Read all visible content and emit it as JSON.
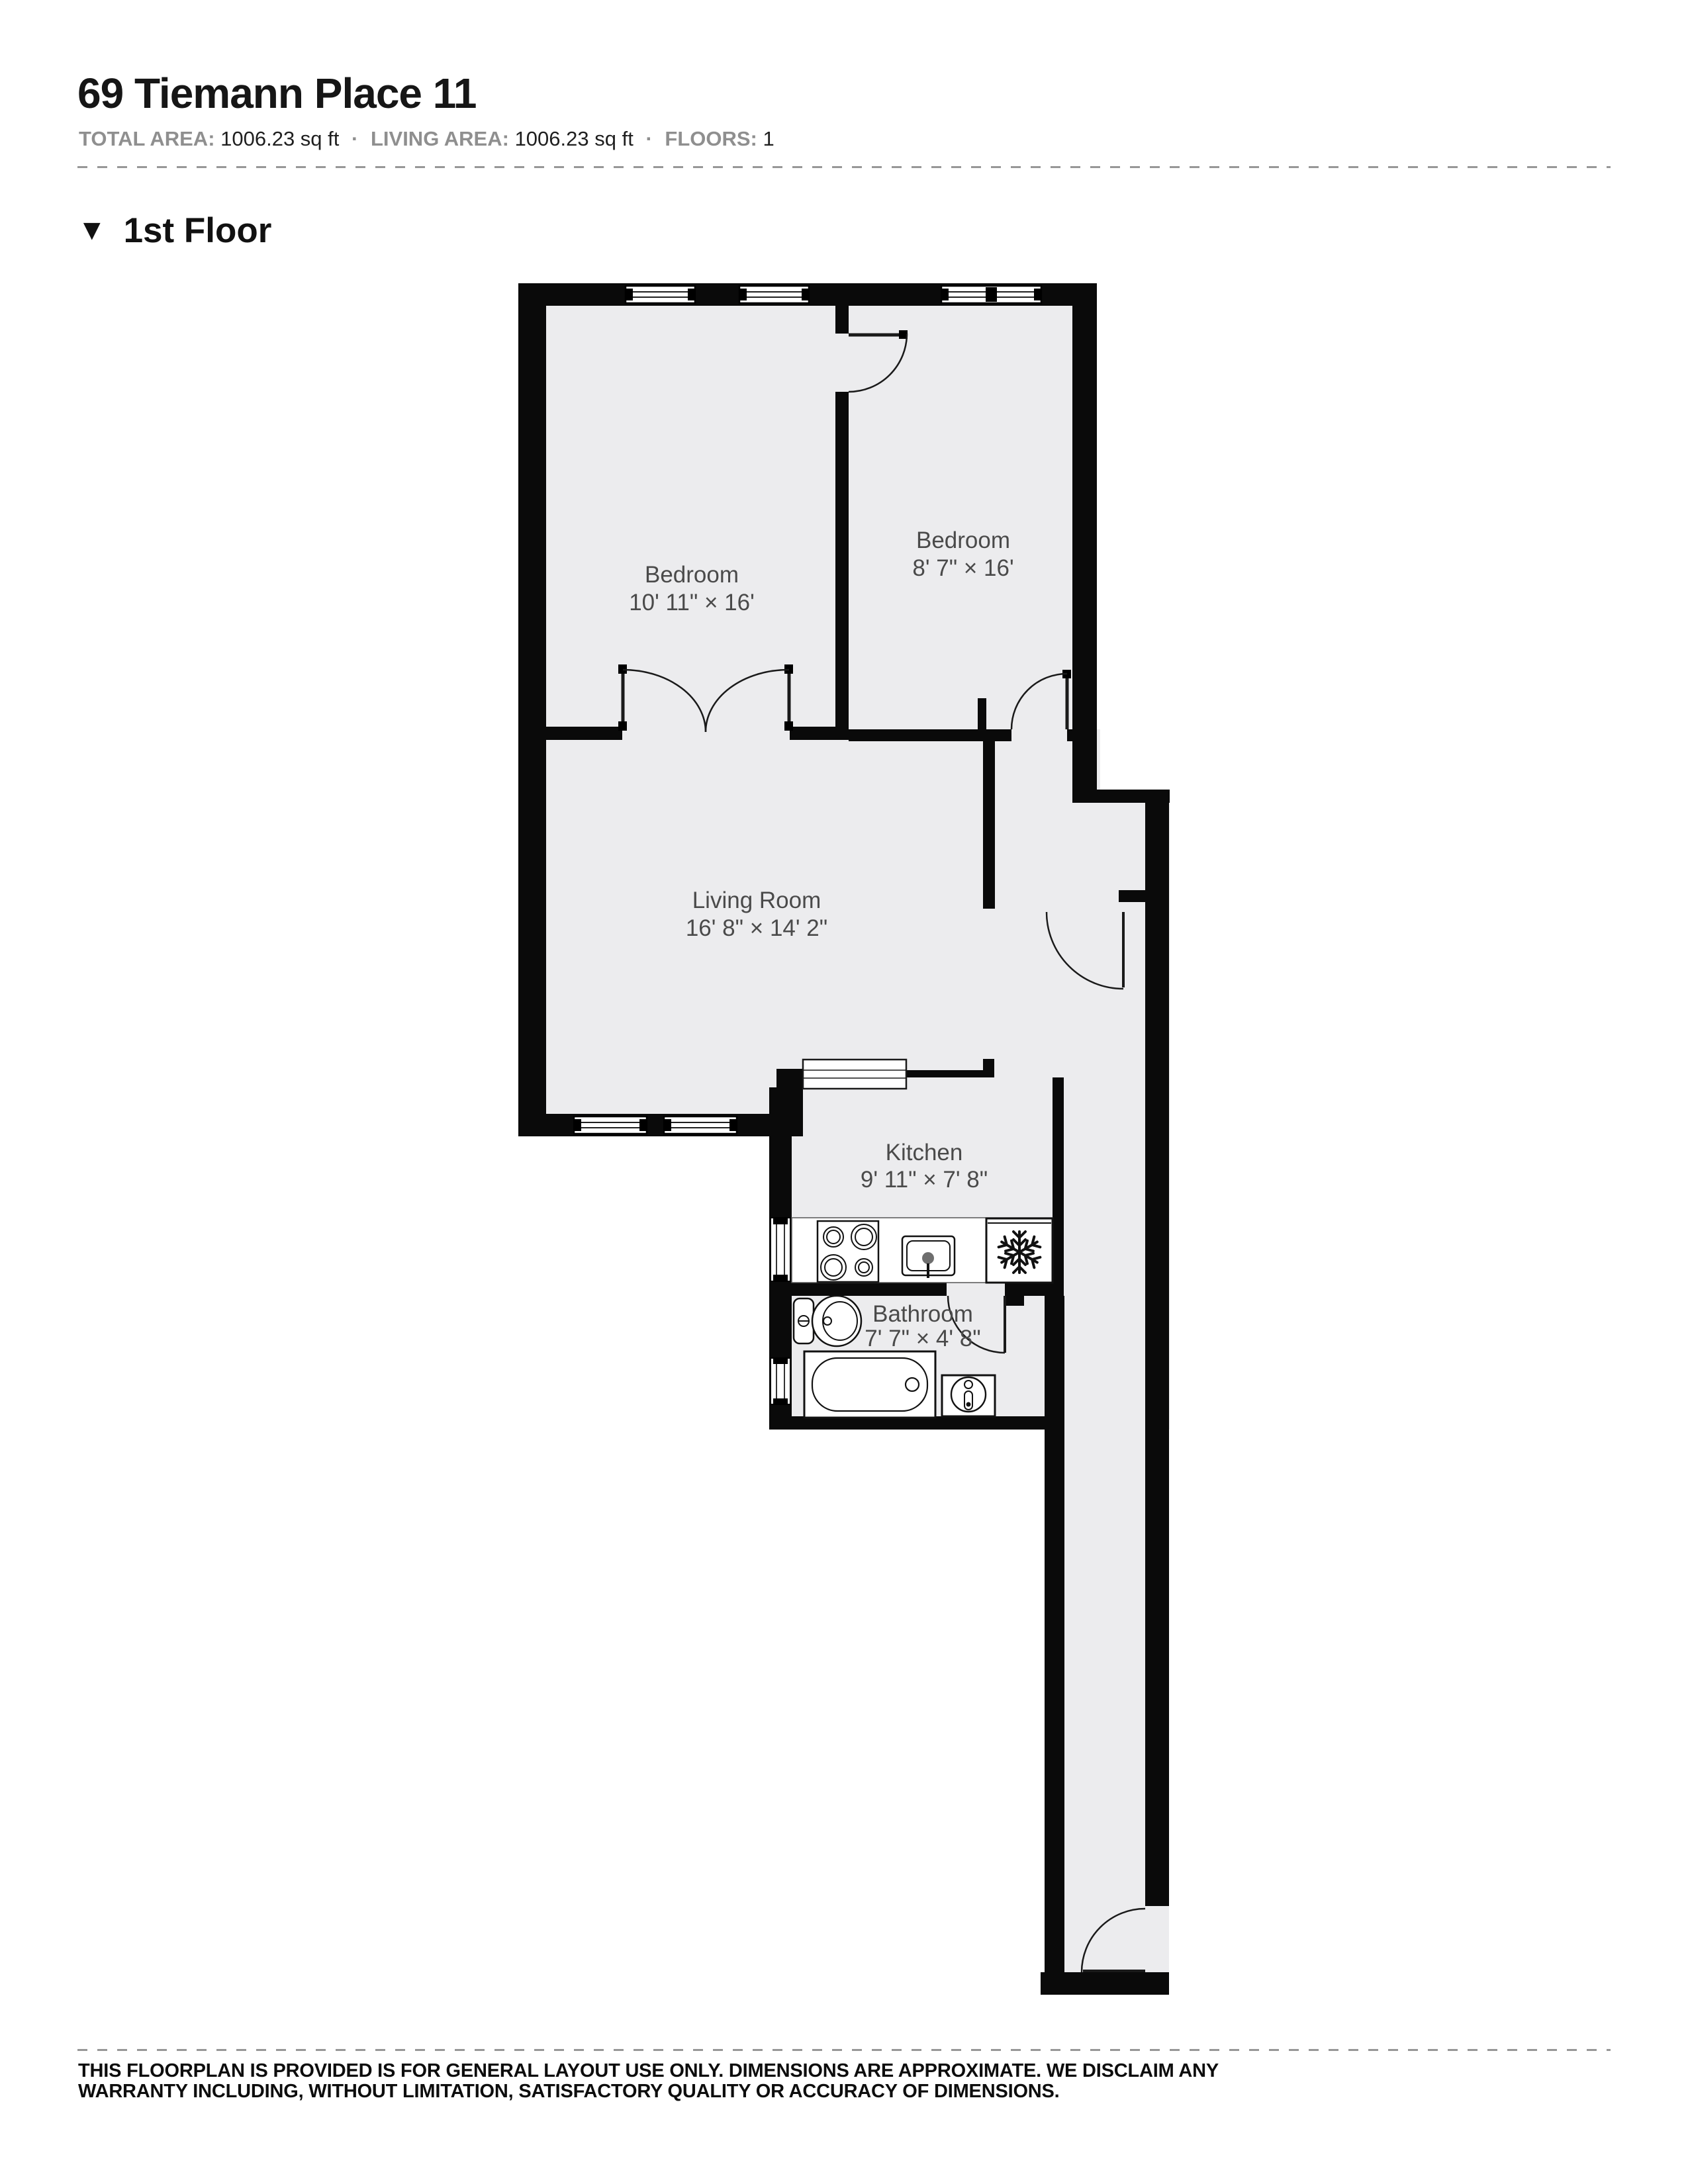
{
  "header": {
    "title": "69 Tiemann Place 11",
    "meta": {
      "total_area_label": "TOTAL AREA:",
      "total_area_value": "1006.23 sq ft",
      "living_area_label": "LIVING AREA:",
      "living_area_value": "1006.23 sq ft",
      "floors_label": "FLOORS:",
      "floors_value": "1",
      "separator": "·"
    }
  },
  "floor_section": {
    "marker": "▼",
    "label": "1st Floor"
  },
  "rooms": [
    {
      "id": "bedroom-1",
      "name": "Bedroom",
      "dims": "10' 11\" × 16'"
    },
    {
      "id": "bedroom-2",
      "name": "Bedroom",
      "dims": "8' 7\" × 16'"
    },
    {
      "id": "living-room",
      "name": "Living Room",
      "dims": "16' 8\" × 14' 2\""
    },
    {
      "id": "kitchen",
      "name": "Kitchen",
      "dims": "9' 11\" × 7' 8\""
    },
    {
      "id": "bathroom",
      "name": "Bathroom",
      "dims": "7' 7\" × 4' 8\""
    }
  ],
  "fixtures": [
    "stove-icon",
    "kitchen-sink-icon",
    "fridge-snowflake-icon",
    "toilet-icon",
    "bathtub-icon",
    "bathroom-sink-icon"
  ],
  "footer": {
    "disclaimer_line1": "THIS FLOORPLAN IS PROVIDED IS FOR GENERAL LAYOUT USE ONLY. DIMENSIONS ARE APPROXIMATE. WE DISCLAIM ANY",
    "disclaimer_line2": "WARRANTY INCLUDING, WITHOUT LIMITATION, SATISFACTORY QUALITY OR ACCURACY OF DIMENSIONS."
  },
  "colors": {
    "wall": "#0a0a0a",
    "floor": "#ECECEE",
    "label": "#4a4a4a",
    "muted_label": "#8f8f8f"
  }
}
